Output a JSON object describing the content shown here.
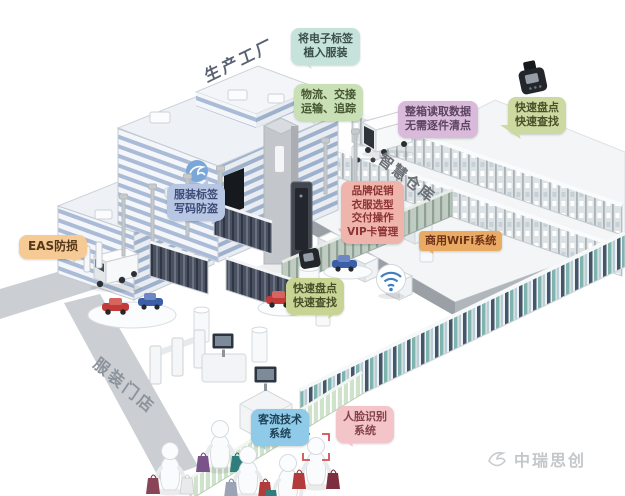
{
  "scene": {
    "factory_label": "生产工厂",
    "warehouse_label": "智慧仓库",
    "store_label": "服装门店"
  },
  "callouts": {
    "tag_implant": "将电子标签\n植入服装",
    "logistics": "物流、交接\n运输、追踪",
    "box_read": "整箱读取数据\n无需逐件清点",
    "quick_count_warehouse": "快速盘点\n快速查找",
    "garment_tag": "服装标签\n写码防盗",
    "brand_promo": "品牌促销\n衣服选型\n交付操作\nVIP卡管理",
    "eas": "EAS防损",
    "commercial_wifi": "商用WiFi系统",
    "quick_count_store": "快速盘点\n快速查找",
    "customer_flow": "客流技术\n系统",
    "face_recognition": "人脸识别\n系统"
  },
  "branding": {
    "logo_text": "中瑞思创"
  },
  "colors": {
    "callout_tag_implant_bg": "#c5e3db",
    "callout_logistics_bg": "#c9dfb5",
    "callout_box_read_bg": "#d9bada",
    "callout_quick_count_bg": "#ccd9a1",
    "callout_garment_tag_bg": "#b7c6e3",
    "callout_brand_promo_bg": "#efb4ab",
    "callout_eas_bg": "#f5ca95",
    "callout_wifi_bg": "#e9aa64",
    "callout_traffic_bg": "#8fcae8",
    "callout_face_bg": "#f3c4c8",
    "building_window_blue": "#a9bbd6",
    "wifi_wave_blue": "#3f7fc1",
    "road_gray": "#cbcfd3"
  }
}
